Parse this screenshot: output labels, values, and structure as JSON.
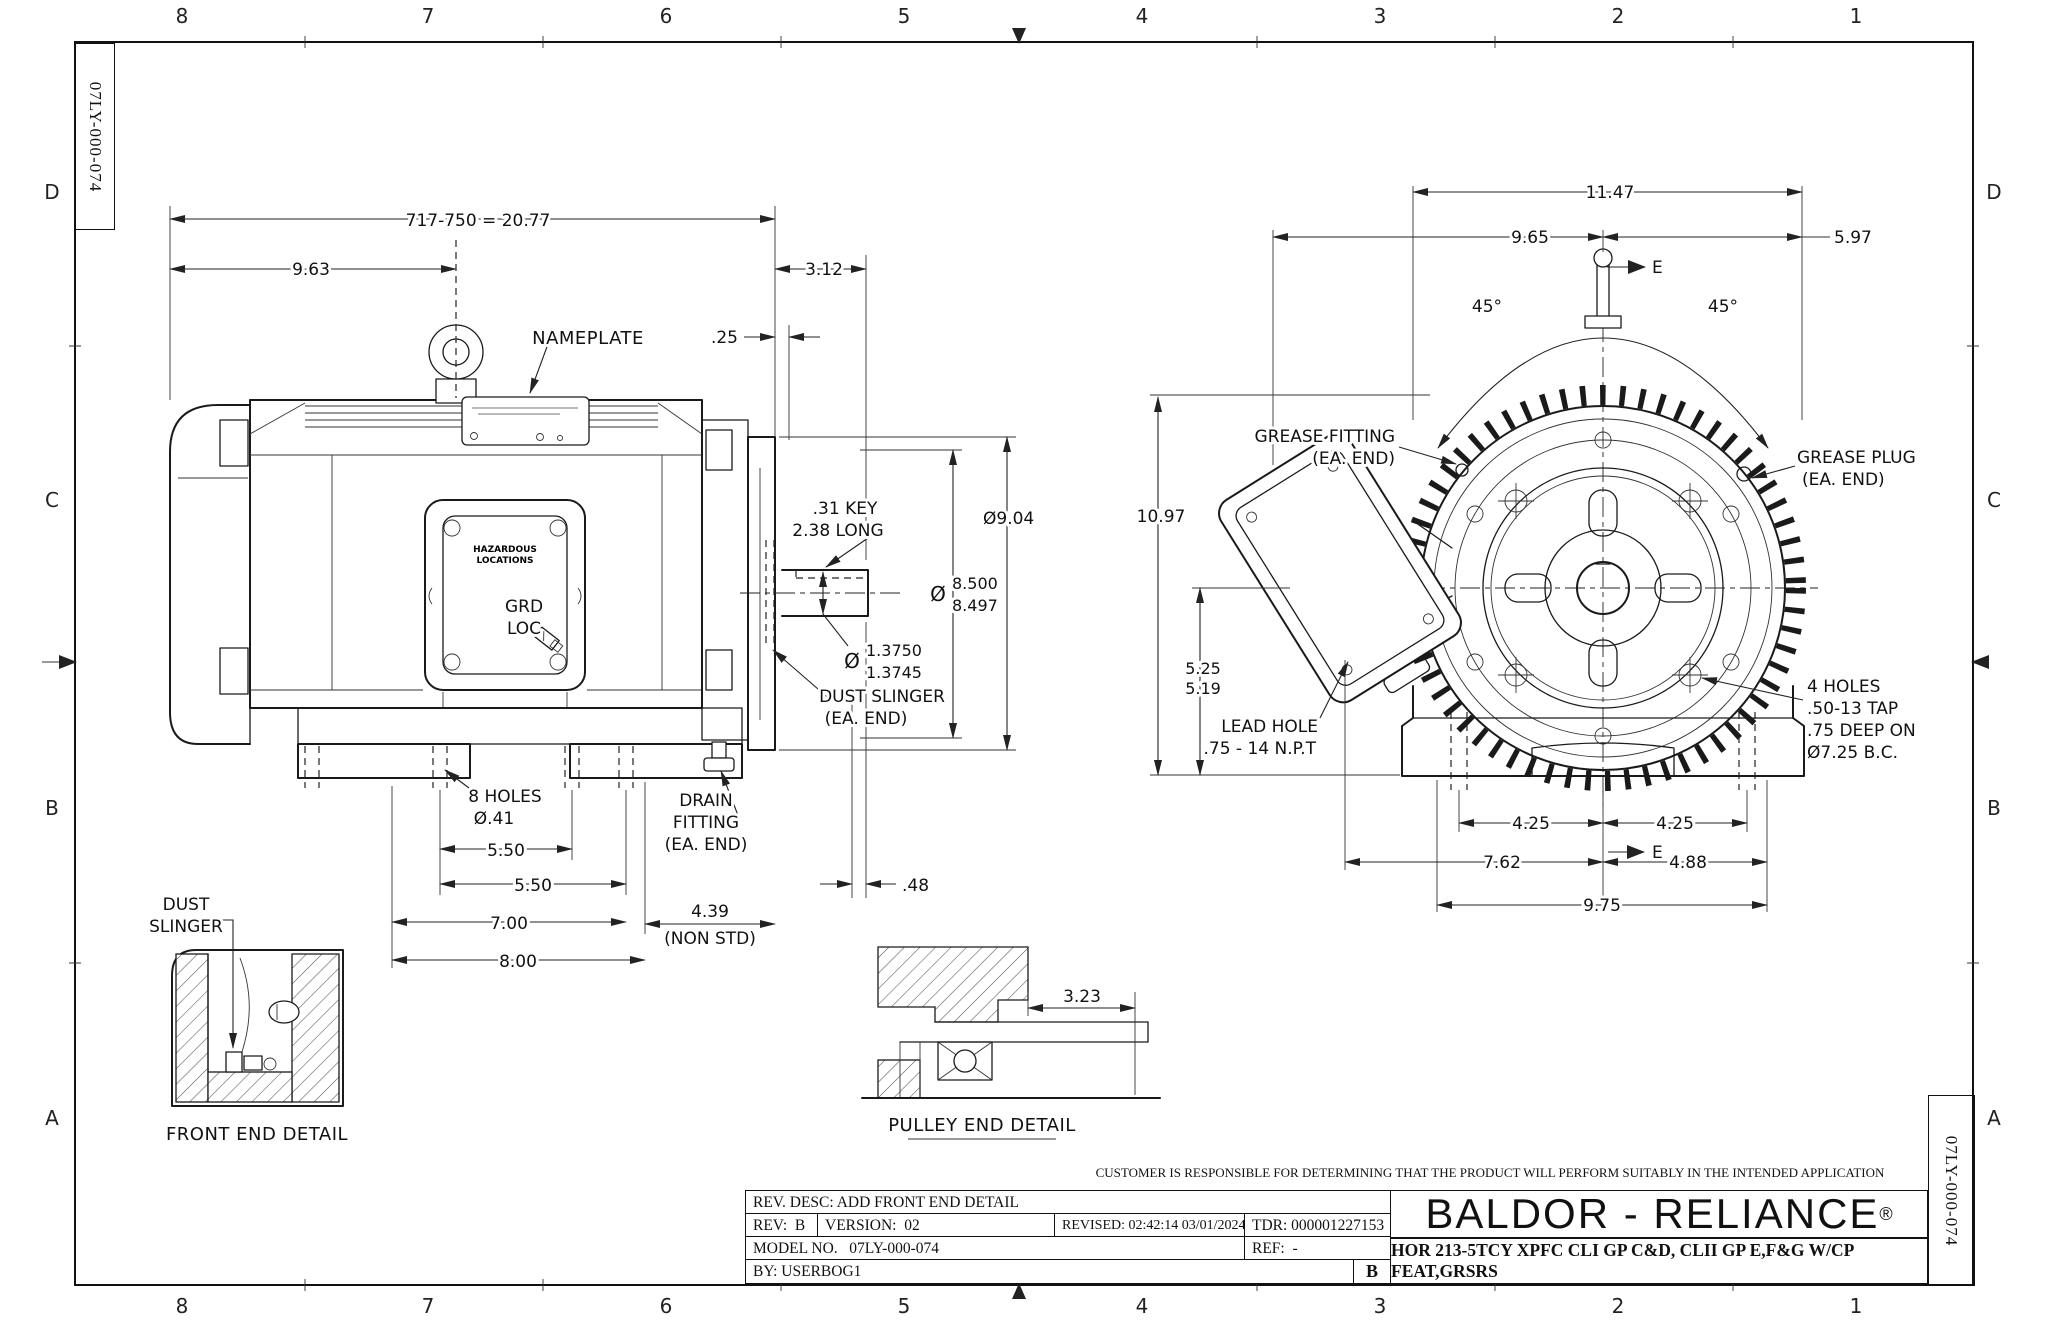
{
  "doc_number": "07LY-000-074",
  "grid": {
    "top": [
      "8",
      "7",
      "6",
      "5",
      "4",
      "3",
      "2",
      "1"
    ],
    "bottom": [
      "8",
      "7",
      "6",
      "5",
      "4",
      "3",
      "2",
      "1"
    ],
    "left": [
      "D",
      "C",
      "B",
      "A"
    ],
    "right": [
      "D",
      "C",
      "B",
      "A"
    ]
  },
  "side": {
    "overall": "717-750 = 20.77",
    "len963": "9.63",
    "len312": "3.12",
    "gap25": ".25",
    "nameplate": "NAMEPLATE",
    "key1": ".31 KEY",
    "key2": "2.38 LONG",
    "dia904": "Ø9.04",
    "dia_sym": "Ø",
    "ak1": "8.500",
    "ak2": "8.497",
    "shaft_sym": "Ø",
    "shaft1": "1.3750",
    "shaft2": "1.3745",
    "slinger1": "DUST SLINGER",
    "slinger2": "(EA. END)",
    "drain1": "DRAIN",
    "drain2": "FITTING",
    "drain3": "(EA. END)",
    "holes1": "8 HOLES",
    "holes2": "Ø.41",
    "f550a": "5.50",
    "f550b": "5.50",
    "f700": "7.00",
    "f800": "8.00",
    "f48": ".48",
    "f439a": "4.39",
    "f439b": "(NON STD)",
    "haz1": "HAZARDOUS",
    "haz2": "LOCATIONS",
    "grd1": "GRD",
    "grd2": "LOC"
  },
  "end": {
    "w1147": "11.47",
    "w965": "9.65",
    "w597": "5.97",
    "a45l": "45°",
    "a45r": "45°",
    "sec_top": "E",
    "sec_bot": "E",
    "h1097": "10.97",
    "h525": "5.25",
    "h519": "5.19",
    "gf1": "GREASE FITTING",
    "gf2": "(EA. END)",
    "gp1": "GREASE PLUG",
    "gp2": "(EA. END)",
    "lh1": "LEAD HOLE",
    "lh2": ".75 - 14 N.P.T",
    "th1": "4 HOLES",
    "th2": ".50-13 TAP",
    "th3": ".75 DEEP ON",
    "th4": "Ø7.25 B.C.",
    "f425l": "4.25",
    "f425r": "4.25",
    "f762": "7.62",
    "f488": "4.88",
    "f975": "9.75"
  },
  "front_detail": {
    "lbl1": "DUST",
    "lbl2": "SLINGER",
    "caption": "FRONT END DETAIL"
  },
  "pulley_detail": {
    "caption": "PULLEY END DETAIL",
    "d323": "3.23"
  },
  "title_block": {
    "disclaimer": "CUSTOMER IS RESPONSIBLE FOR DETERMINING THAT THE PRODUCT WILL PERFORM SUITABLY IN THE INTENDED APPLICATION",
    "rev_desc": "REV. DESC: ADD FRONT END DETAIL",
    "rev": "REV:  B",
    "version": "VERSION:  02",
    "revised": "REVISED: 02:42:14 03/01/2024",
    "tdr": "TDR: 000001227153",
    "model": "MODEL NO.   07LY-000-074",
    "ref": "REF:  -",
    "by": "BY: USERBOG1",
    "corner_rev": "B",
    "brand": "BALDOR - RELIANCE",
    "reg": "®",
    "desc": "HOR 213-5TCY XPFC CLI GP C&D, CLII GP E,F&G W/CP FEAT,GRSRS"
  }
}
